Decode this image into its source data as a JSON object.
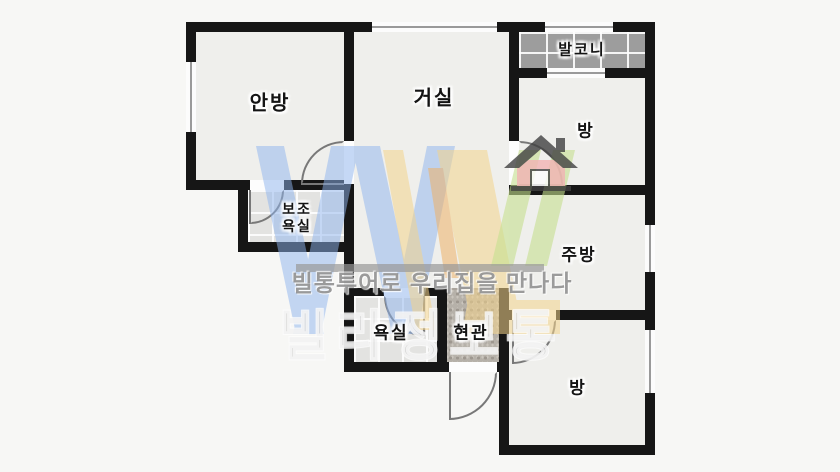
{
  "plan": {
    "type": "apartment-floor-plan",
    "labels": {
      "anbang": "안방",
      "geosil": "거실",
      "balcony": "발코니",
      "bang_top": "방",
      "bojo_line1": "보조",
      "bojo_line2": "욕실",
      "jubang": "주방",
      "yoksil": "욕실",
      "hyeongwan": "현관",
      "bang_bottom": "방"
    }
  },
  "watermark": {
    "slogan": "빌통투어로 우리집을 만나다",
    "brand": "빌라정보통",
    "colors": {
      "wall": "#161616",
      "floor": "#efefec",
      "tile": "#e3e3e1",
      "balcony_floor": "#9d9d9d",
      "entry_floor": "#b6b1a9",
      "logo_blue": "#8fb4ee",
      "logo_yellow": "#f4d48c",
      "logo_orange": "#eeb268",
      "logo_green": "#c6e08f",
      "house_pink": "#f2b4b4",
      "house_roof": "#414141",
      "bar_gray": "#999999",
      "slogan_gray": "#8a8a8a"
    }
  }
}
